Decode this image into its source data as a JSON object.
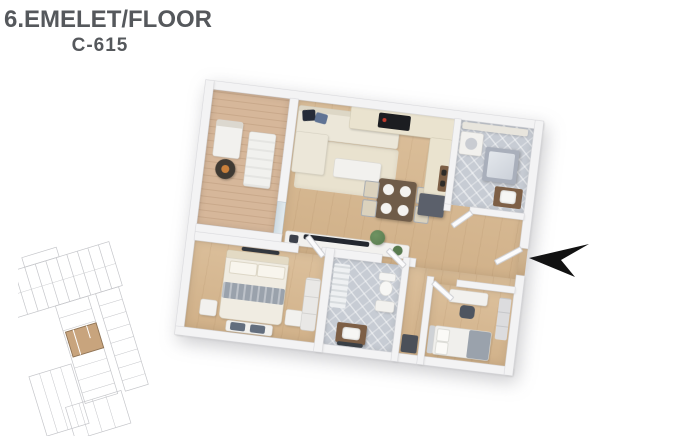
{
  "header": {
    "title": "6.EMELET/FLOOR",
    "unit_code": "C-615"
  },
  "icons": {
    "entrance_arrow": "arrow-pointing-left-at-entrance",
    "site_plan_highlight": "highlighted-apartment-location"
  },
  "colors": {
    "title_text": "#55585c",
    "wall": "#f3f3f4",
    "wood_floor": "#dcc09c",
    "balcony_deck": "#d6b79a",
    "tile_floor": "#c7ccd4",
    "counter": "#eae3cf",
    "sofa": "#ece7d9",
    "rug": "#e9e2cf",
    "dark_cabinet": "#5b606b",
    "table_wood": "#6f5c49",
    "vanity_wood": "#7d5f46",
    "pillow_navy": "#252b38",
    "pillow_slate": "#5f7394",
    "blanket_gray": "#9aa2ac",
    "plant_green": "#587a4e",
    "arrow": "#121212",
    "plan_line": "#c5c6ca",
    "highlight_unit": "#c8a47d"
  }
}
